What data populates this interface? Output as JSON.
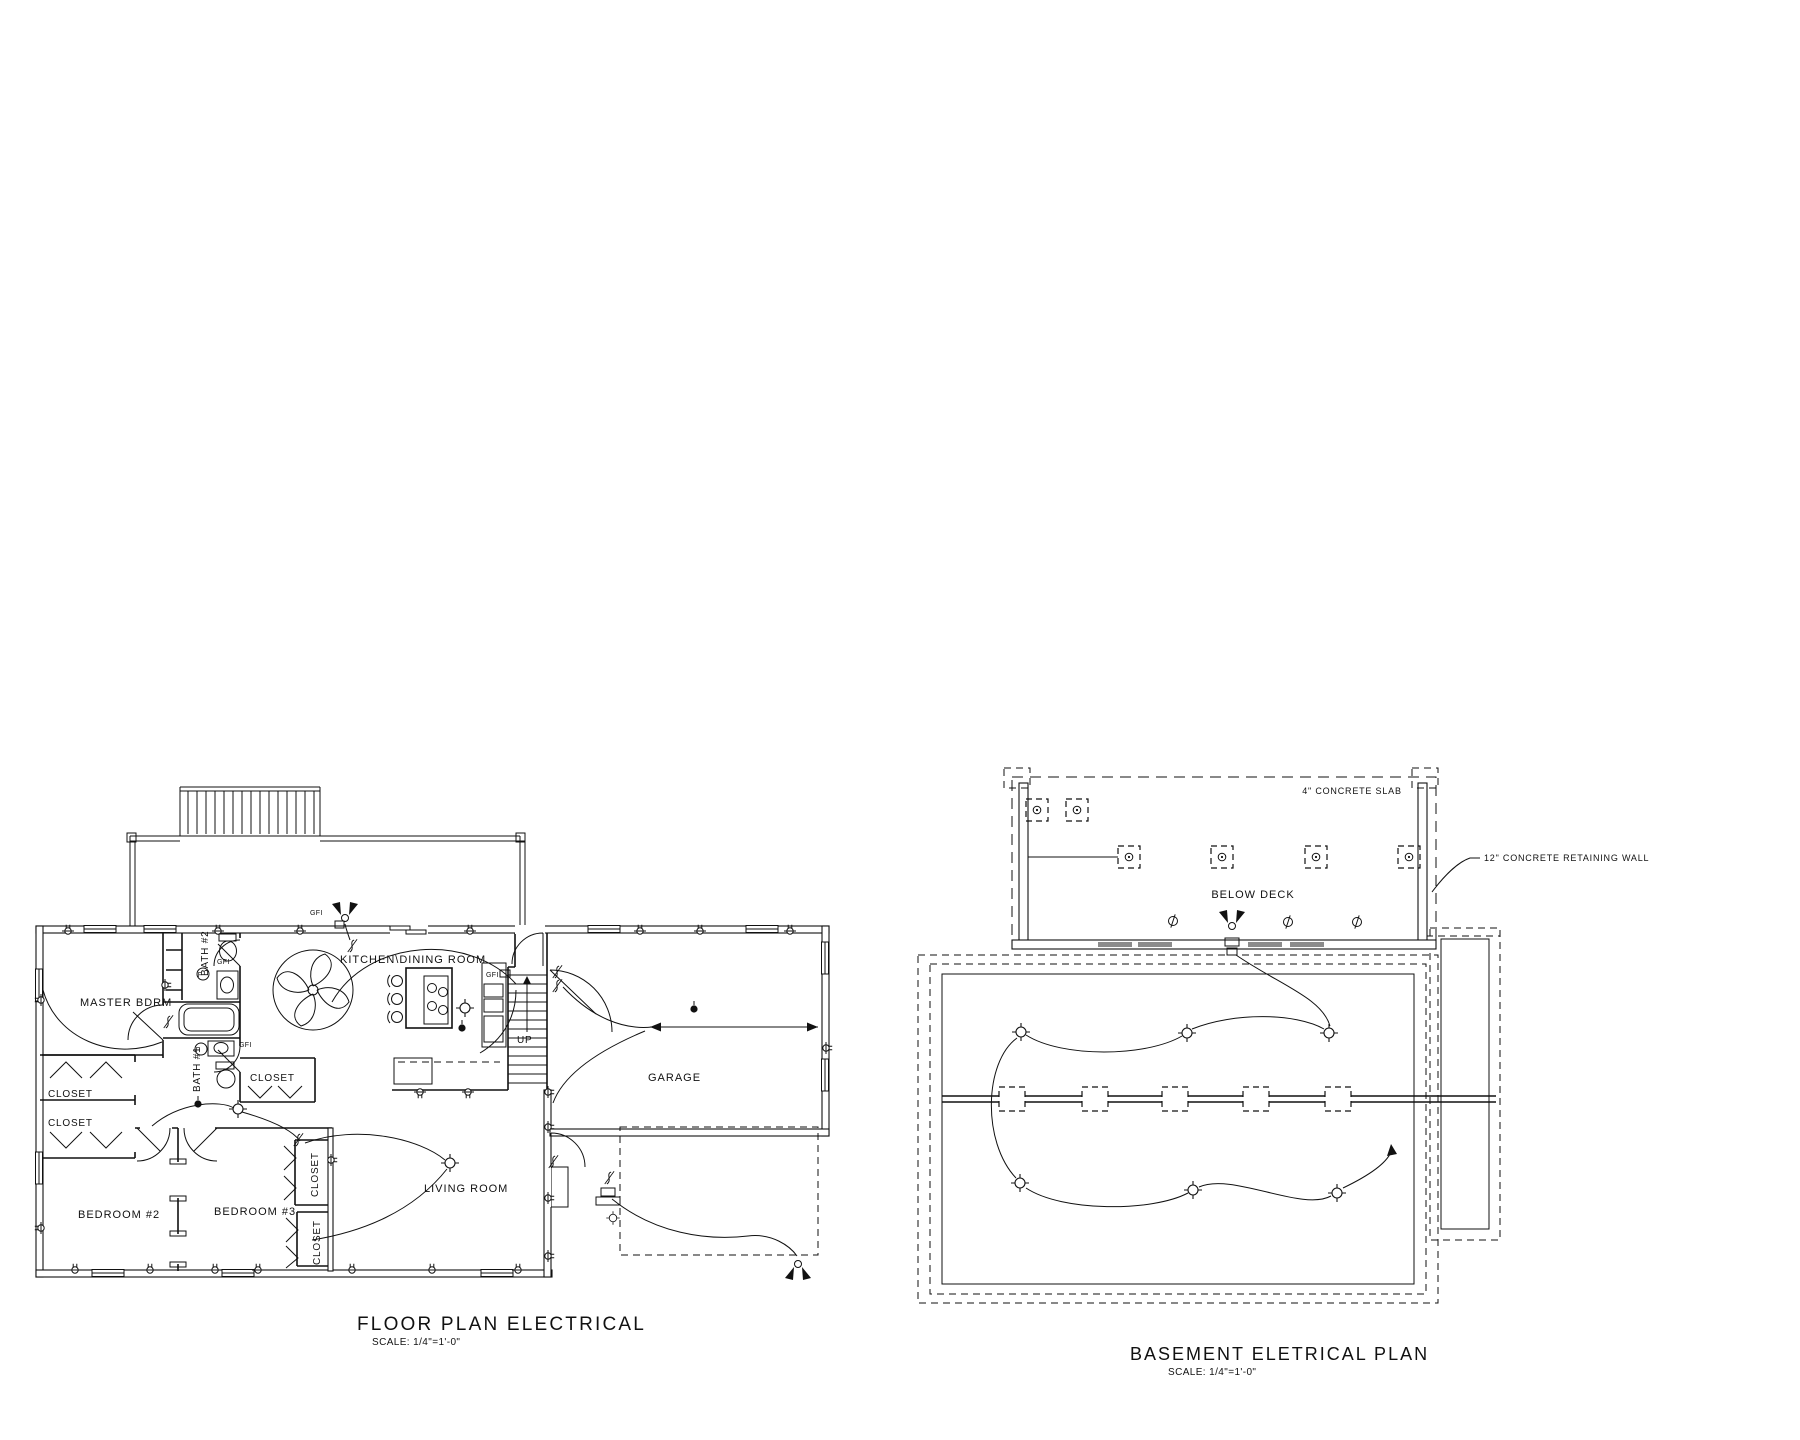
{
  "floor_plan": {
    "title": "FLOOR PLAN ELECTRICAL",
    "scale": "SCALE: 1/4\"=1'-0\"",
    "rooms": {
      "master_bdrm": "MASTER BDRM",
      "kitchen_dining": "KITCHEN\\DINING ROOM",
      "living_room": "LIVING ROOM",
      "garage": "GARAGE",
      "bedroom_2": "BEDROOM #2",
      "bedroom_3": "BEDROOM #3",
      "bath_1": "BATH #1",
      "bath_2": "BATH #2",
      "closet": "CLOSET",
      "stairs_up": "UP"
    },
    "electrical": {
      "gfi": "GFI",
      "fan": "F"
    }
  },
  "basement_plan": {
    "title": "BASEMENT ELETRICAL PLAN",
    "scale": "SCALE: 1/4\"=1'-0\"",
    "annotations": {
      "below_deck": "BELOW DECK",
      "concrete_slab": "4\" CONCRETE SLAB",
      "retaining_wall": "12\" CONCRETE RETAINING WALL"
    }
  }
}
